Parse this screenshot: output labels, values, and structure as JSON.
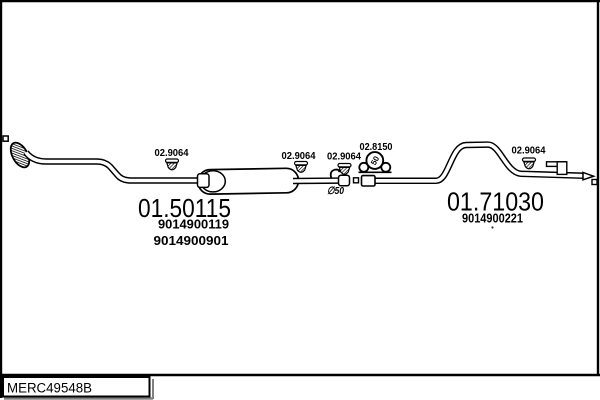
{
  "catalog": {
    "drawing_code": "MERC49548B"
  },
  "front_section": {
    "part_number": "01.50115",
    "oe_numbers": [
      "9014900119",
      "9014900901"
    ]
  },
  "rear_section": {
    "part_number": "01.71030",
    "oe_numbers": [
      "9014900221"
    ]
  },
  "fittings": {
    "hanger_labels": [
      "02.9064",
      "02.9064",
      "02.9064",
      "02.9064"
    ],
    "clamp_label": "02.8150",
    "clamp_size": "50",
    "pipe_diameter": "∅50"
  },
  "colors": {
    "line": "#000000",
    "background": "#ffffff",
    "shadow": "#808080"
  }
}
